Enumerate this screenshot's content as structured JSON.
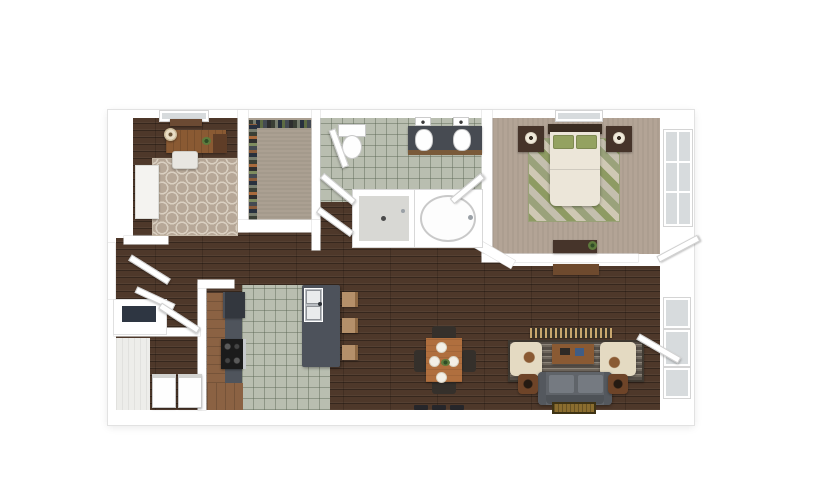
{
  "scene": {
    "title": "3D top-down floor plan — one-bedroom apartment with den, walk-in closet, bathroom, open kitchen / dining / living area and laundry closet",
    "view": "top-down 3D render",
    "visible_text": "none"
  },
  "palette": {
    "canvas_bg": "#ffffff",
    "wall": "#ffffff",
    "wall_edge": "#e2e2e2",
    "wood": "#4e382a",
    "tile": "#b9beb0",
    "closet_carpet": "#aba092",
    "bedroom_carpet": "#b3a496",
    "den_rug": "#b7a898",
    "den_rug_motif": "#d9cfc1",
    "bed_rug_green": "#8e9b63",
    "bed_rug_tan": "#cfc8b4",
    "island": "#4d525b",
    "counter": "#4f545c",
    "cabinet_wood": "#8b6243",
    "appliance_dark": "#33373e",
    "sofa": "#60646a",
    "armchair": "#e4dac2",
    "living_rug": "#554e47",
    "coffee_table": "#8a5a33",
    "dining_wood": "#b06f3e",
    "chair_dark": "#35302b",
    "furniture_dark_wood": "#46342a",
    "bed_linen": "#ece6d9",
    "pillow_green": "#94a261",
    "doormat_gold": "#8a6d2f",
    "glass": "#d7dbdd",
    "shower_floor": "#d8d8d4"
  },
  "rooms": {
    "den": {
      "label": "Den / office"
    },
    "closet": {
      "label": "Walk-in closet"
    },
    "bathroom": {
      "label": "Bathroom"
    },
    "bedroom": {
      "label": "Bedroom"
    },
    "kitchen": {
      "label": "Kitchen"
    },
    "living": {
      "label": "Living / dining area"
    },
    "laundry": {
      "label": "Laundry closet"
    },
    "entry": {
      "label": "Entry"
    }
  },
  "furniture": {
    "den": [
      "desk",
      "desk lamp",
      "plant",
      "desk chair",
      "bookcase",
      "quatrefoil area rug",
      "wall shelf",
      "window"
    ],
    "closet": [
      "hanging clothes (two racks)"
    ],
    "bathroom": [
      "toilet",
      "double vanity with two sinks",
      "walk-in shower",
      "bathtub"
    ],
    "bedroom": [
      "bed with green pillows",
      "headboard",
      "nightstand x2",
      "lamp x2",
      "diamond-pattern rug",
      "dresser",
      "console table",
      "window x2"
    ],
    "kitchen": [
      "refrigerator",
      "range with 4 burners",
      "L-shaped counter",
      "island with double sink",
      "bar stool x3"
    ],
    "living": [
      "dining table",
      "dining chair x4",
      "plates x4",
      "media console",
      "striped area rug",
      "armchair x2",
      "coffee table",
      "sofa",
      "side table with lamp x2",
      "doormat",
      "floor vent",
      "windows",
      "patio door"
    ],
    "laundry": [
      "washer",
      "dryer"
    ],
    "entry": [
      "double entry doors",
      "coat closet"
    ]
  }
}
